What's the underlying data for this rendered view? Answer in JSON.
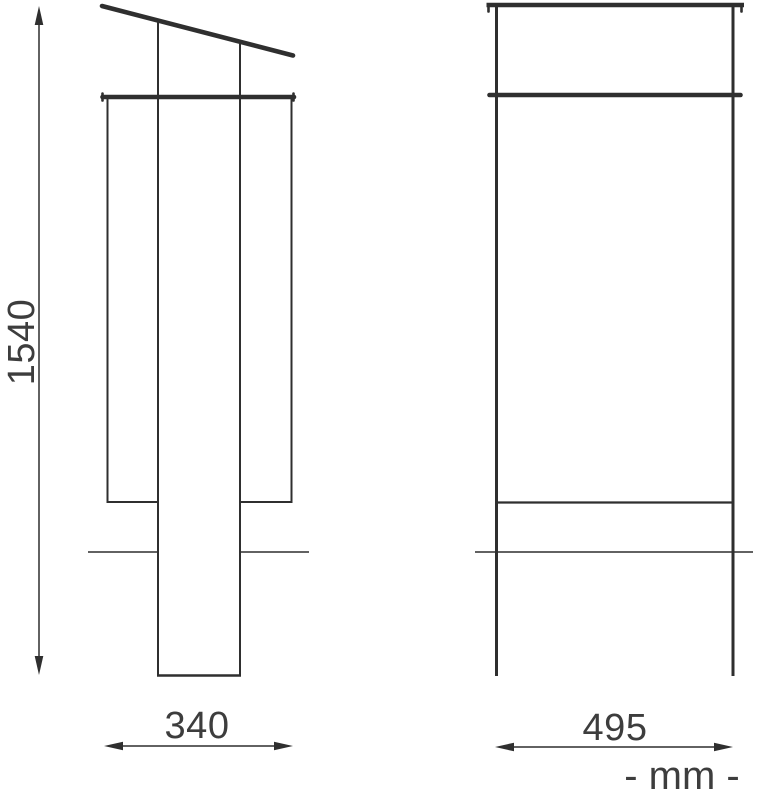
{
  "drawing": {
    "unit_label": "- mm -",
    "dimensions": {
      "height_mm": "1540",
      "side_depth_mm": "340",
      "front_width_mm": "495"
    },
    "colors": {
      "line": "#2f2f2f",
      "text": "#3d3d3d",
      "background": "#ffffff"
    }
  }
}
